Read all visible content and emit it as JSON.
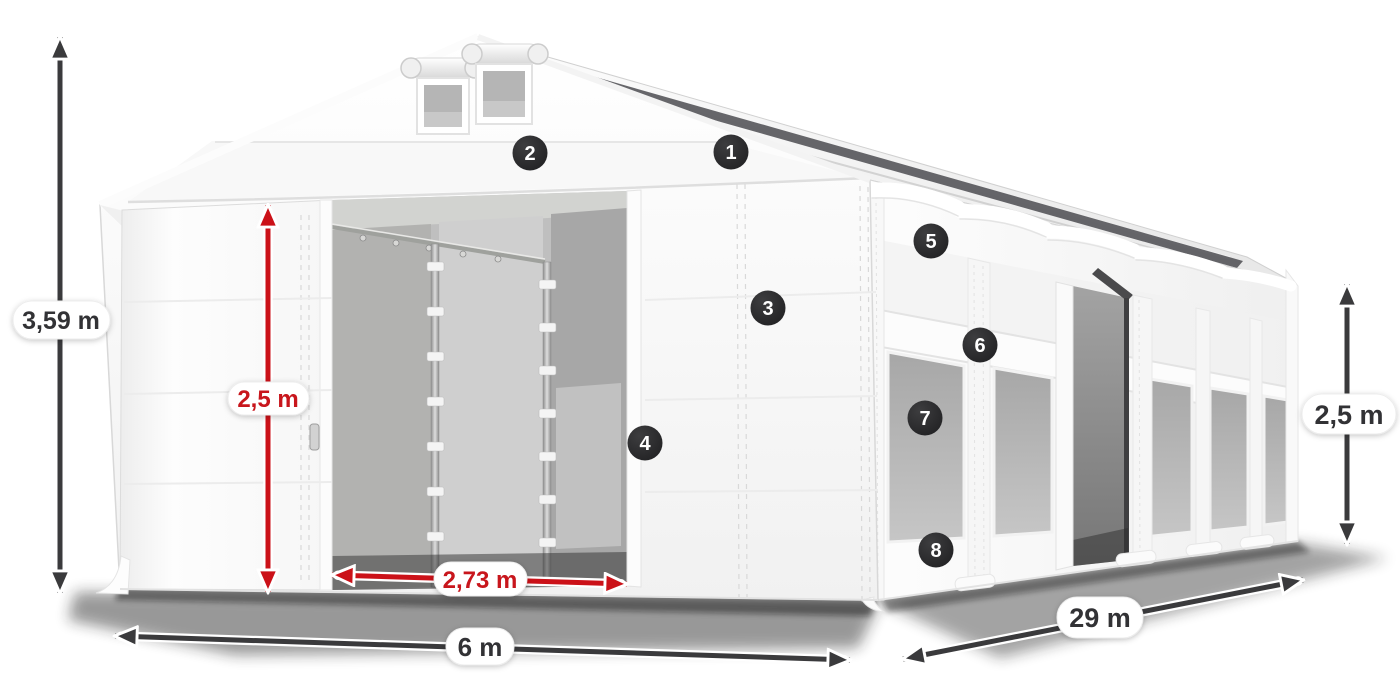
{
  "figure": {
    "title": "Tent hall dimension diagram",
    "badges": [
      {
        "label": "1"
      },
      {
        "label": "2"
      },
      {
        "label": "3"
      },
      {
        "label": "4"
      },
      {
        "label": "5"
      },
      {
        "label": "6"
      },
      {
        "label": "7"
      },
      {
        "label": "8"
      }
    ],
    "dimensions": {
      "total_height": "3,59 m",
      "door_height": "2,5 m",
      "door_width": "2,73 m",
      "front_width": "6 m",
      "length": "29 m",
      "side_height": "2,5 m"
    },
    "colors": {
      "dimension_dark": "#3a3a3c",
      "dimension_red": "#cb1118",
      "label_background": "#ffffff",
      "label_text_dark": "#333336",
      "label_text_red": "#c8121a",
      "badge_background": "#2a2a2c",
      "badge_text": "#ffffff",
      "tent_white": "#ffffff"
    }
  }
}
